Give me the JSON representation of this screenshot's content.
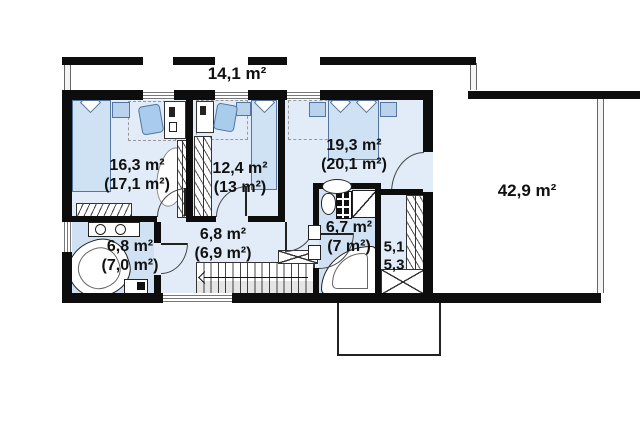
{
  "plan": {
    "type": "floor-plan",
    "rooms": [
      {
        "name": "balcony",
        "area": "14,1 m²"
      },
      {
        "name": "bedroom-left",
        "area": "16,3 m²",
        "area_total": "(17,1 m²)"
      },
      {
        "name": "room-middle",
        "area": "12,4 m²",
        "area_total": "(13 m²)"
      },
      {
        "name": "bedroom-right",
        "area": "19,3 m²",
        "area_total": "(20,1 m²)"
      },
      {
        "name": "terrace",
        "area": "42,9 m²"
      },
      {
        "name": "bathroom-left",
        "area": "6,8 m²",
        "area_total": "(7,0 m²)"
      },
      {
        "name": "hallway",
        "area": "6,8 m²",
        "area_total": "(6,9 m²)"
      },
      {
        "name": "bathroom-right",
        "area": "6,7 m²",
        "area_total": "(7 m²)"
      },
      {
        "name": "wardrobe",
        "area": "5,1",
        "area_total": "5,3"
      }
    ],
    "colors": {
      "wall": "#0d0d0d",
      "room_fill": "#e2ecf8",
      "bath_fill": "#cfe1f3",
      "furniture_fill": "#cfe2f4",
      "background": "#ffffff"
    }
  }
}
